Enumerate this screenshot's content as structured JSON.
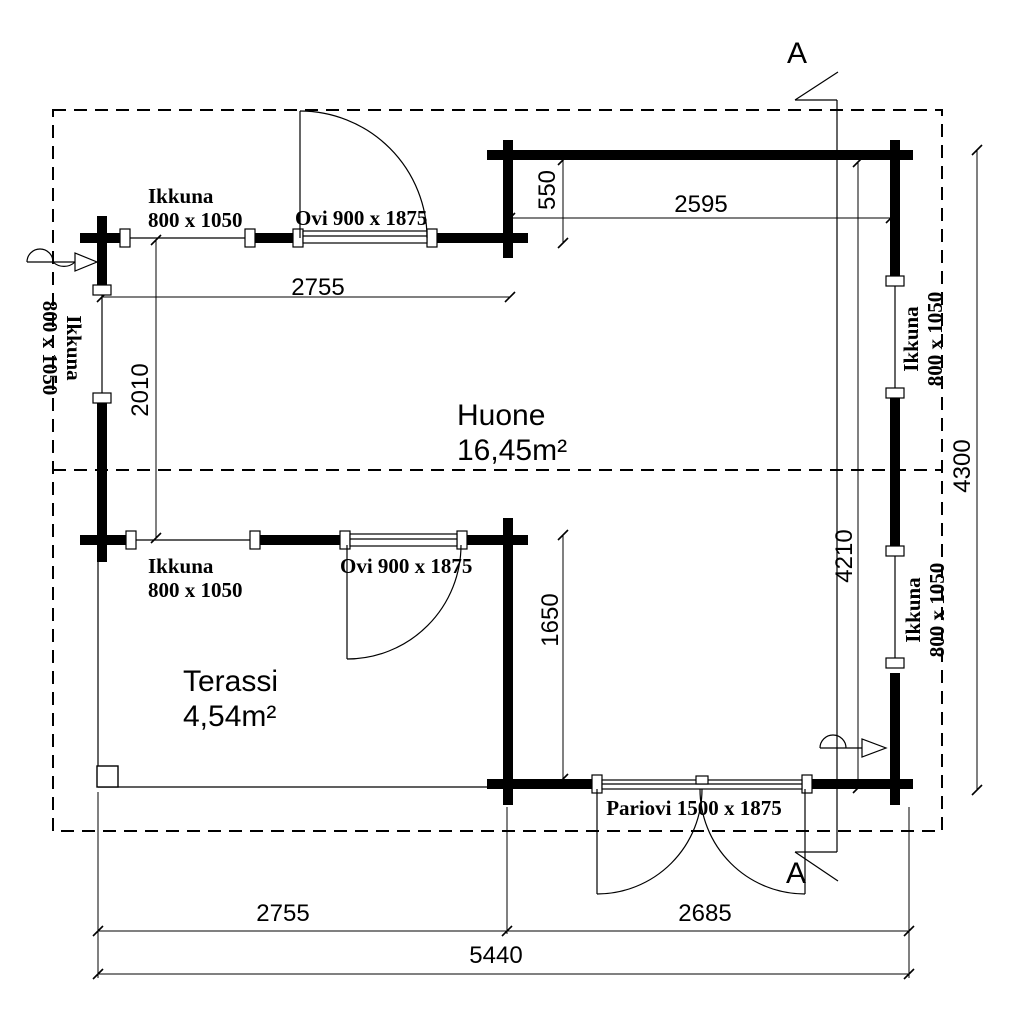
{
  "rooms": {
    "huone": {
      "name": "Huone",
      "area": "16,45m²"
    },
    "terassi": {
      "name": "Terassi",
      "area": "4,54m²"
    }
  },
  "openings": {
    "window": {
      "type": "Ikkuna",
      "size": "800 x 1050"
    },
    "door": {
      "label": "Ovi 900 x 1875"
    },
    "double_door": {
      "label": "Pariovi 1500 x 1875"
    }
  },
  "dimensions_mm": {
    "top_left_width": "2755",
    "front_recess_depth": "550",
    "top_right_width": "2595",
    "left_room_height": "2010",
    "right_total_depth": "4300",
    "right_inner_depth": "4210",
    "terrace_opening_depth": "1650",
    "bottom_left_width": "2755",
    "bottom_right_width": "2685",
    "total_width": "5440"
  },
  "section": {
    "marker": "A"
  },
  "colors": {
    "ink": "#000000",
    "paper": "#ffffff"
  }
}
